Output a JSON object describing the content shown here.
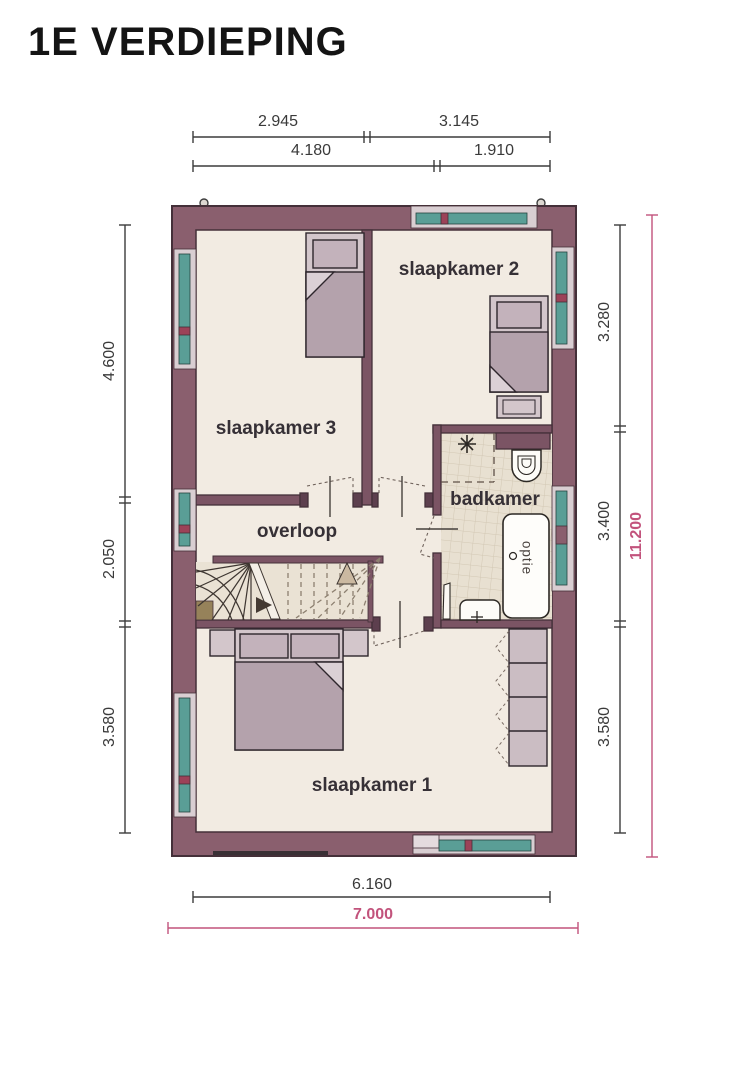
{
  "title": "1E VERDIEPING",
  "floor_plan": {
    "rooms": {
      "slaapkamer_1": "slaapkamer 1",
      "slaapkamer_2": "slaapkamer 2",
      "slaapkamer_3": "slaapkamer 3",
      "overloop": "overloop",
      "badkamer": "badkamer"
    },
    "bathtub_option": "optie"
  },
  "dims": {
    "top1a": "2.945",
    "top1b": "3.145",
    "top2a": "4.180",
    "top2b": "1.910",
    "left1": "4.600",
    "left2": "2.050",
    "left3": "3.580",
    "right1": "3.280",
    "right2": "3.400",
    "right3": "3.580",
    "right_total": "11.200",
    "bottom_inner": "6.160",
    "bottom_outer": "7.000"
  },
  "colors": {
    "wall": "#8a5f6e",
    "interior_wall": "#7b5464",
    "accent_dimension": "#c2537c",
    "window_glass": "#5a9e96",
    "floor": "#f2ebe2",
    "bathroom_tile": "#e8e0d1",
    "furniture": "#d3c6cb",
    "blanket": "#b4a2ac"
  }
}
